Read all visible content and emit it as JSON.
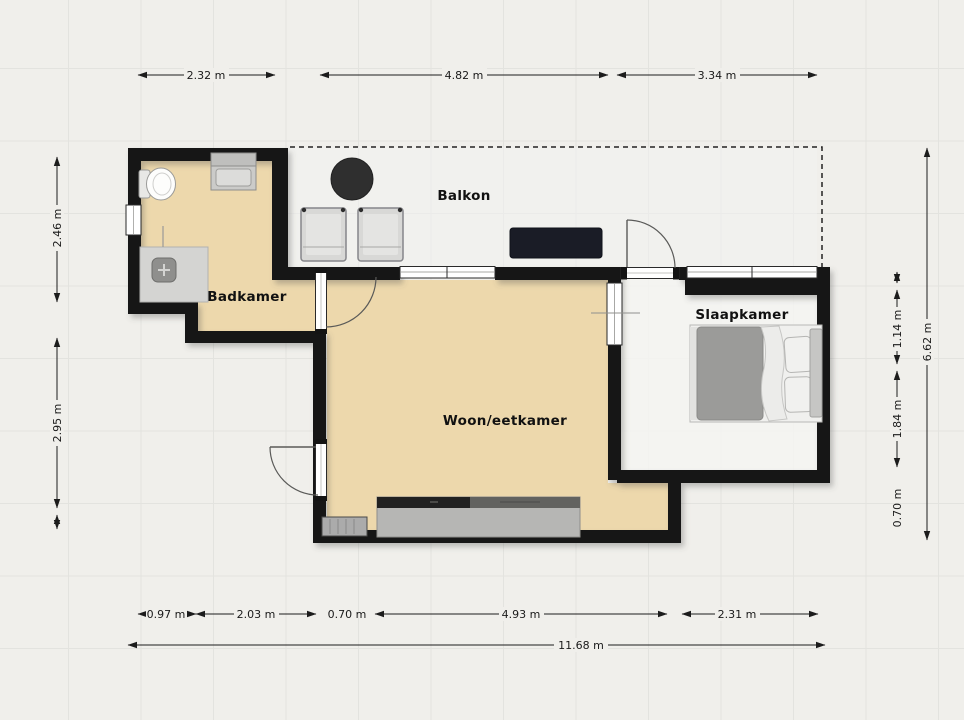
{
  "rooms": {
    "badkamer": {
      "label": "Badkamer"
    },
    "balkon": {
      "label": "Balkon"
    },
    "woon_eetkamer": {
      "label": "Woon/eetkamer"
    },
    "slaapkamer": {
      "label": "Slaapkamer"
    }
  },
  "dimensions": {
    "top": [
      {
        "label": "2.32 m"
      },
      {
        "label": "4.82 m"
      },
      {
        "label": "3.34 m"
      }
    ],
    "left": [
      {
        "label": "2.46 m"
      },
      {
        "label": "2.95 m"
      }
    ],
    "right": [
      {
        "label": "1.14 m"
      },
      {
        "label": "1.84 m"
      },
      {
        "label": "0.70 m"
      }
    ],
    "right_total": {
      "label": "6.62 m"
    },
    "bottom": [
      {
        "label": "0.97 m"
      },
      {
        "label": "2.03 m"
      },
      {
        "label": "0.70 m"
      },
      {
        "label": "4.93 m"
      },
      {
        "label": "2.31 m"
      }
    ],
    "bottom_total": {
      "label": "11.68 m"
    }
  },
  "furniture": {
    "toilet": "toilet",
    "sink": "sink-vanity",
    "shower": "shower",
    "table": "round-table",
    "chairs": "balcony-chairs",
    "bench": "tv-bench",
    "bed": "double-bed",
    "counter": "kitchen-counter",
    "radiator": "radiator"
  },
  "colors": {
    "wall": "#141414",
    "floor_tan": "#edd8ac",
    "background": "#f0efeb",
    "bench_dark": "#1a1c26",
    "table_dark": "#2f2f2f"
  }
}
